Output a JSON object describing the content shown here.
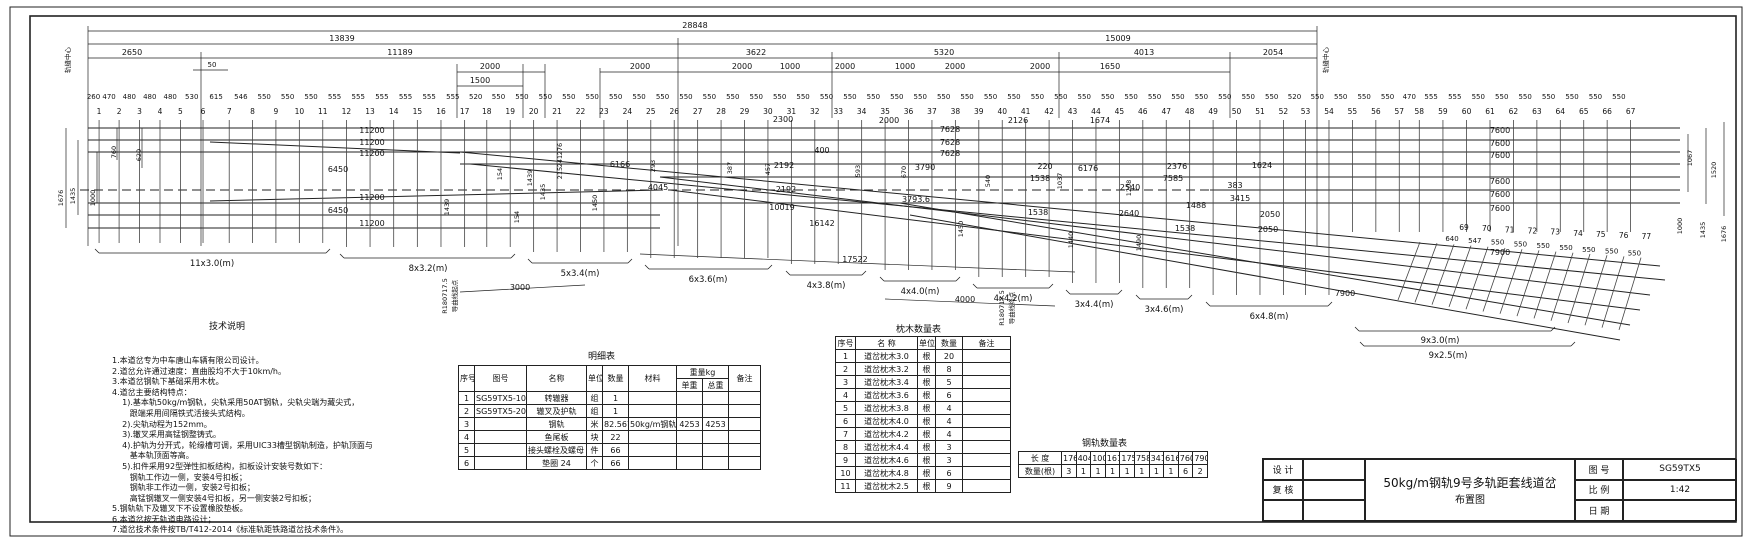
{
  "title_block": {
    "design_label": "设 计",
    "check_label": "复 核",
    "drawing_title_line1": "50kg/m钢轨9号多轨距套线道岔",
    "drawing_title_line2": "布置图",
    "fig_no_label": "图 号",
    "fig_no": "SG59TX5",
    "scale_label": "比 例",
    "scale": "1:42",
    "date_label": "日 期"
  },
  "notes": {
    "title": "技术说明",
    "lines": [
      "1.本道岔专为中车唐山车辆有限公司设计。",
      "2.道岔允许通过速度：直曲股均不大于10km/h。",
      "3.本道岔钢轨下基础采用木枕。",
      "4.道岔主要结构特点：",
      "    1).基本轨50kg/m钢轨，尖轨采用50AT钢轨，尖轨尖端为藏尖式，",
      "       跟端采用间隔铁式活接头式结构。",
      "    2).尖轨动程为152mm。",
      "    3).辙叉采用高锰钢整铸式。",
      "    4).护轨为分开式，轮缘槽可调，采用UIC33槽型钢轨制造，护轨顶面与",
      "       基本轨顶面等高。",
      "    5).扣件采用92型弹性扣板结构，扣板设计安装号数如下：",
      "       钢轨工作边一侧，安装4号扣板；",
      "       钢轨非工作边一侧，安装2号扣板；",
      "       高锰钢辙叉一侧安装4号扣板，另一侧安装2号扣板；",
      "5.钢轨轨下及辙叉下不设置橡胶垫板。",
      "6.本道岔按无轨道电路设计；",
      "7.道岔技术条件按TB/T412-2014《标准轨距铁路道岔技术条件》。"
    ]
  },
  "tables": {
    "parts": {
      "title": "明细表",
      "headers": {
        "seq": "序号",
        "fig": "图号",
        "name": "名称",
        "unit": "单位",
        "qty": "数量",
        "material": "材料",
        "weight_group": "重量kg",
        "unit_weight": "单重",
        "total_weight": "总重",
        "remark": "备注"
      },
      "rows": [
        [
          "1",
          "SG59TX5-100",
          "转辙器",
          "组",
          "1",
          "",
          "",
          "",
          ""
        ],
        [
          "2",
          "SG59TX5-200",
          "辙叉及护轨",
          "组",
          "1",
          "",
          "",
          "",
          ""
        ],
        [
          "3",
          "",
          "钢轨",
          "米",
          "82.567",
          "50kg/m钢轨",
          "4253",
          "4253",
          ""
        ],
        [
          "4",
          "",
          "鱼尾板",
          "块",
          "22",
          "",
          "",
          "",
          ""
        ],
        [
          "5",
          "",
          "接头螺栓及螺母 M24",
          "件",
          "66",
          "",
          "",
          "",
          ""
        ],
        [
          "6",
          "",
          "垫圈 24",
          "个",
          "66",
          "",
          "",
          "",
          ""
        ]
      ]
    },
    "sleepers": {
      "title": "枕木数量表",
      "headers": [
        "序号",
        "名 称",
        "单位",
        "数量",
        "备注"
      ],
      "rows": [
        [
          "1",
          "道岔枕木3.0",
          "根",
          "20",
          ""
        ],
        [
          "2",
          "道岔枕木3.2",
          "根",
          "8",
          ""
        ],
        [
          "3",
          "道岔枕木3.4",
          "根",
          "5",
          ""
        ],
        [
          "4",
          "道岔枕木3.6",
          "根",
          "6",
          ""
        ],
        [
          "5",
          "道岔枕木3.8",
          "根",
          "4",
          ""
        ],
        [
          "6",
          "道岔枕木4.0",
          "根",
          "4",
          ""
        ],
        [
          "7",
          "道岔枕木4.2",
          "根",
          "4",
          ""
        ],
        [
          "8",
          "道岔枕木4.4",
          "根",
          "3",
          ""
        ],
        [
          "9",
          "道岔枕木4.6",
          "根",
          "3",
          ""
        ],
        [
          "10",
          "道岔枕木4.8",
          "根",
          "6",
          ""
        ],
        [
          "11",
          "道岔枕木2.5",
          "根",
          "9",
          ""
        ]
      ]
    },
    "rails": {
      "title": "钢轨数量表",
      "length_label": "长 度",
      "qty_label": "数量(根)",
      "lengths": [
        "17628",
        "4045",
        "10019",
        "16142",
        "17522",
        "7585",
        "3415",
        "6166",
        "7600",
        "7900"
      ],
      "qtys": [
        "3",
        "1",
        "1",
        "1",
        "1",
        "1",
        "1",
        "1",
        "6",
        "2"
      ]
    }
  },
  "drawing": {
    "sleeper_numbers": [
      "1",
      "2",
      "3",
      "4",
      "5",
      "6",
      "7",
      "8",
      "9",
      "10",
      "11",
      "12",
      "13",
      "14",
      "15",
      "16",
      "17",
      "18",
      "19",
      "20",
      "21",
      "22",
      "23",
      "24",
      "25",
      "26",
      "27",
      "28",
      "29",
      "30",
      "31",
      "32",
      "33",
      "34",
      "35",
      "36",
      "37",
      "38",
      "39",
      "40",
      "41",
      "42",
      "43",
      "44",
      "45",
      "46",
      "47",
      "48",
      "49",
      "50",
      "51",
      "52",
      "53",
      "54",
      "55",
      "56",
      "57",
      "58",
      "59",
      "60",
      "61",
      "62",
      "63",
      "64",
      "65",
      "66",
      "67"
    ],
    "sleeper_spacings": [
      "260",
      "470",
      "480",
      "480",
      "480",
      "530",
      "615",
      "546",
      "550",
      "550",
      "550",
      "555",
      "555",
      "555",
      "555",
      "555",
      "555",
      "520",
      "550",
      "550",
      "550",
      "550",
      "550",
      "550",
      "550",
      "550",
      "550",
      "550",
      "550",
      "550",
      "550",
      "550",
      "550",
      "550",
      "550",
      "550",
      "550",
      "550",
      "550",
      "550",
      "550",
      "550",
      "550",
      "550",
      "550",
      "550",
      "550",
      "550",
      "550",
      "550",
      "550",
      "550",
      "520",
      "550",
      "550",
      "550",
      "550",
      "470",
      "555",
      "555",
      "550",
      "550",
      "550",
      "550",
      "550",
      "550",
      "550"
    ],
    "branch_numbers": [
      "69",
      "70",
      "71",
      "72",
      "73",
      "74",
      "75",
      "76",
      "77"
    ],
    "branch_spacings": [
      "640",
      "547",
      "550",
      "550",
      "550",
      "550",
      "550",
      "550",
      "550"
    ],
    "labels": [
      {
        "t": "28848",
        "x": 695,
        "y": 28
      },
      {
        "t": "13839",
        "x": 342,
        "y": 41
      },
      {
        "t": "15009",
        "x": 1118,
        "y": 41
      },
      {
        "t": "2650",
        "x": 132,
        "y": 55
      },
      {
        "t": "11189",
        "x": 400,
        "y": 55
      },
      {
        "t": "3622",
        "x": 756,
        "y": 55
      },
      {
        "t": "5320",
        "x": 944,
        "y": 55
      },
      {
        "t": "4013",
        "x": 1144,
        "y": 55
      },
      {
        "t": "2054",
        "x": 1273,
        "y": 55
      },
      {
        "t": "2000",
        "x": 490,
        "y": 69
      },
      {
        "t": "2000",
        "x": 640,
        "y": 69
      },
      {
        "t": "2000",
        "x": 742,
        "y": 69
      },
      {
        "t": "1000",
        "x": 790,
        "y": 69
      },
      {
        "t": "2000",
        "x": 845,
        "y": 69
      },
      {
        "t": "1000",
        "x": 905,
        "y": 69
      },
      {
        "t": "2000",
        "x": 955,
        "y": 69
      },
      {
        "t": "2000",
        "x": 1040,
        "y": 69
      },
      {
        "t": "1650",
        "x": 1110,
        "y": 69
      },
      {
        "t": "1500",
        "x": 480,
        "y": 83
      },
      {
        "t": "50",
        "x": 212,
        "y": 67,
        "s": 7
      },
      {
        "t": "轨缝中心",
        "x": 70,
        "y": 60,
        "r": 1,
        "s": 6.5
      },
      {
        "t": "轨缝中心",
        "x": 1328,
        "y": 60,
        "r": 1,
        "s": 6.5
      },
      {
        "t": "1676",
        "x": 63,
        "y": 198,
        "r": 1,
        "s": 6.5
      },
      {
        "t": "1435",
        "x": 75,
        "y": 196,
        "r": 1,
        "s": 6.5
      },
      {
        "t": "1000",
        "x": 95,
        "y": 198,
        "r": 1,
        "s": 6.5
      },
      {
        "t": "760",
        "x": 116,
        "y": 152,
        "r": 1,
        "s": 6.5
      },
      {
        "t": "620",
        "x": 141,
        "y": 155,
        "r": 1,
        "s": 6.5
      },
      {
        "t": "11200",
        "x": 372,
        "y": 133
      },
      {
        "t": "11200",
        "x": 372,
        "y": 145
      },
      {
        "t": "11200",
        "x": 372,
        "y": 156
      },
      {
        "t": "6450",
        "x": 338,
        "y": 172
      },
      {
        "t": "11200",
        "x": 372,
        "y": 200
      },
      {
        "t": "6450",
        "x": 338,
        "y": 213
      },
      {
        "t": "11200",
        "x": 372,
        "y": 226
      },
      {
        "t": "154",
        "x": 502,
        "y": 174,
        "r": 1,
        "s": 6.5
      },
      {
        "t": "1439",
        "x": 532,
        "y": 178,
        "r": 1,
        "s": 6.5
      },
      {
        "t": "1435",
        "x": 545,
        "y": 192,
        "r": 1,
        "s": 6.5
      },
      {
        "t": "1439",
        "x": 449,
        "y": 207,
        "r": 1,
        "s": 6.5
      },
      {
        "t": "154",
        "x": 519,
        "y": 217,
        "r": 1,
        "s": 6.5
      },
      {
        "t": "1450",
        "x": 597,
        "y": 203,
        "r": 1,
        "s": 6.5
      },
      {
        "t": "276",
        "x": 562,
        "y": 149,
        "r": 1,
        "s": 6.5
      },
      {
        "t": "241",
        "x": 562,
        "y": 161,
        "r": 1,
        "s": 6.5
      },
      {
        "t": "215",
        "x": 562,
        "y": 173,
        "r": 1,
        "s": 6.5
      },
      {
        "t": "6166",
        "x": 620,
        "y": 167
      },
      {
        "t": "4045",
        "x": 658,
        "y": 190
      },
      {
        "t": "2300",
        "x": 783,
        "y": 122
      },
      {
        "t": "2000",
        "x": 889,
        "y": 123
      },
      {
        "t": "400",
        "x": 822,
        "y": 153
      },
      {
        "t": "2192",
        "x": 784,
        "y": 168
      },
      {
        "t": "2192",
        "x": 786,
        "y": 192
      },
      {
        "t": "10019",
        "x": 782,
        "y": 210
      },
      {
        "t": "16142",
        "x": 822,
        "y": 226
      },
      {
        "t": "3790",
        "x": 925,
        "y": 170
      },
      {
        "t": "3793.6",
        "x": 916,
        "y": 202
      },
      {
        "t": "7628",
        "x": 950,
        "y": 132
      },
      {
        "t": "7628",
        "x": 950,
        "y": 145
      },
      {
        "t": "7628",
        "x": 950,
        "y": 156
      },
      {
        "t": "2126",
        "x": 1018,
        "y": 123
      },
      {
        "t": "1674",
        "x": 1100,
        "y": 123
      },
      {
        "t": "220",
        "x": 1045,
        "y": 169
      },
      {
        "t": "1538",
        "x": 1040,
        "y": 181
      },
      {
        "t": "1538",
        "x": 1038,
        "y": 215
      },
      {
        "t": "1538",
        "x": 1185,
        "y": 231
      },
      {
        "t": "6176",
        "x": 1088,
        "y": 171
      },
      {
        "t": "2540",
        "x": 1130,
        "y": 190
      },
      {
        "t": "2640",
        "x": 1129,
        "y": 216
      },
      {
        "t": "2376",
        "x": 1177,
        "y": 169
      },
      {
        "t": "7585",
        "x": 1173,
        "y": 181
      },
      {
        "t": "1488",
        "x": 1196,
        "y": 208
      },
      {
        "t": "383",
        "x": 1235,
        "y": 188
      },
      {
        "t": "3415",
        "x": 1240,
        "y": 201
      },
      {
        "t": "1624",
        "x": 1262,
        "y": 168
      },
      {
        "t": "2050",
        "x": 1270,
        "y": 217
      },
      {
        "t": "2050",
        "x": 1268,
        "y": 232
      },
      {
        "t": "293",
        "x": 655,
        "y": 166,
        "r": 1,
        "s": 6.5
      },
      {
        "t": "387",
        "x": 732,
        "y": 168,
        "r": 1,
        "s": 6.5
      },
      {
        "t": "457",
        "x": 770,
        "y": 169,
        "r": 1,
        "s": 6.5
      },
      {
        "t": "593",
        "x": 860,
        "y": 171,
        "r": 1,
        "s": 6.5
      },
      {
        "t": "670",
        "x": 906,
        "y": 172,
        "r": 1,
        "s": 6.5
      },
      {
        "t": "540",
        "x": 990,
        "y": 181,
        "r": 1,
        "s": 6.5
      },
      {
        "t": "1037",
        "x": 1062,
        "y": 181,
        "r": 1,
        "s": 6.5
      },
      {
        "t": "1208",
        "x": 1131,
        "y": 188,
        "r": 1,
        "s": 6.5
      },
      {
        "t": "1450",
        "x": 963,
        "y": 229,
        "r": 1,
        "s": 6.5
      },
      {
        "t": "1440",
        "x": 1073,
        "y": 240,
        "r": 1,
        "s": 6.5
      },
      {
        "t": "1490",
        "x": 1141,
        "y": 243,
        "r": 1,
        "s": 6.5
      },
      {
        "t": "7600",
        "x": 1500,
        "y": 133
      },
      {
        "t": "7600",
        "x": 1500,
        "y": 146
      },
      {
        "t": "7600",
        "x": 1500,
        "y": 158
      },
      {
        "t": "7600",
        "x": 1500,
        "y": 184
      },
      {
        "t": "7600",
        "x": 1500,
        "y": 197
      },
      {
        "t": "7600",
        "x": 1500,
        "y": 211
      },
      {
        "t": "7900",
        "x": 1500,
        "y": 255
      },
      {
        "t": "7900",
        "x": 1345,
        "y": 296
      },
      {
        "t": "1067",
        "x": 1692,
        "y": 158,
        "r": 1,
        "s": 6.5
      },
      {
        "t": "1520",
        "x": 1716,
        "y": 170,
        "r": 1,
        "s": 6.5
      },
      {
        "t": "1000",
        "x": 1682,
        "y": 226,
        "r": 1,
        "s": 6.5
      },
      {
        "t": "1435",
        "x": 1705,
        "y": 230,
        "r": 1,
        "s": 6.5
      },
      {
        "t": "1676",
        "x": 1726,
        "y": 234,
        "r": 1,
        "s": 6.5
      },
      {
        "t": "11x3.0(m)",
        "x": 212,
        "y": 266,
        "s": 8.5
      },
      {
        "t": "8x3.2(m)",
        "x": 428,
        "y": 271,
        "s": 8.5
      },
      {
        "t": "5x3.4(m)",
        "x": 580,
        "y": 276,
        "s": 8.5
      },
      {
        "t": "6x3.6(m)",
        "x": 708,
        "y": 282,
        "s": 8.5
      },
      {
        "t": "4x3.8(m)",
        "x": 826,
        "y": 288,
        "s": 8.5
      },
      {
        "t": "4x4.0(m)",
        "x": 920,
        "y": 294,
        "s": 8.5
      },
      {
        "t": "4x4.2(m)",
        "x": 1013,
        "y": 301,
        "s": 8.5
      },
      {
        "t": "3x4.4(m)",
        "x": 1094,
        "y": 307,
        "s": 8.5
      },
      {
        "t": "3x4.6(m)",
        "x": 1164,
        "y": 312,
        "s": 8.5
      },
      {
        "t": "6x4.8(m)",
        "x": 1269,
        "y": 319,
        "s": 8.5
      },
      {
        "t": "9x3.0(m)",
        "x": 1440,
        "y": 343,
        "s": 8.5
      },
      {
        "t": "9x2.5(m)",
        "x": 1448,
        "y": 358,
        "s": 8.5
      },
      {
        "t": "3000",
        "x": 520,
        "y": 290
      },
      {
        "t": "4000",
        "x": 965,
        "y": 302
      },
      {
        "t": "17522",
        "x": 855,
        "y": 262
      },
      {
        "t": "R180717.5",
        "x": 447,
        "y": 296,
        "r": 1,
        "s": 6.5
      },
      {
        "t": "导曲线起点",
        "x": 457,
        "y": 296,
        "r": 1,
        "s": 6.5
      },
      {
        "t": "R180717.5",
        "x": 1004,
        "y": 308,
        "r": 1,
        "s": 6.5
      },
      {
        "t": "导曲线终点",
        "x": 1014,
        "y": 308,
        "r": 1,
        "s": 6.5
      }
    ]
  }
}
